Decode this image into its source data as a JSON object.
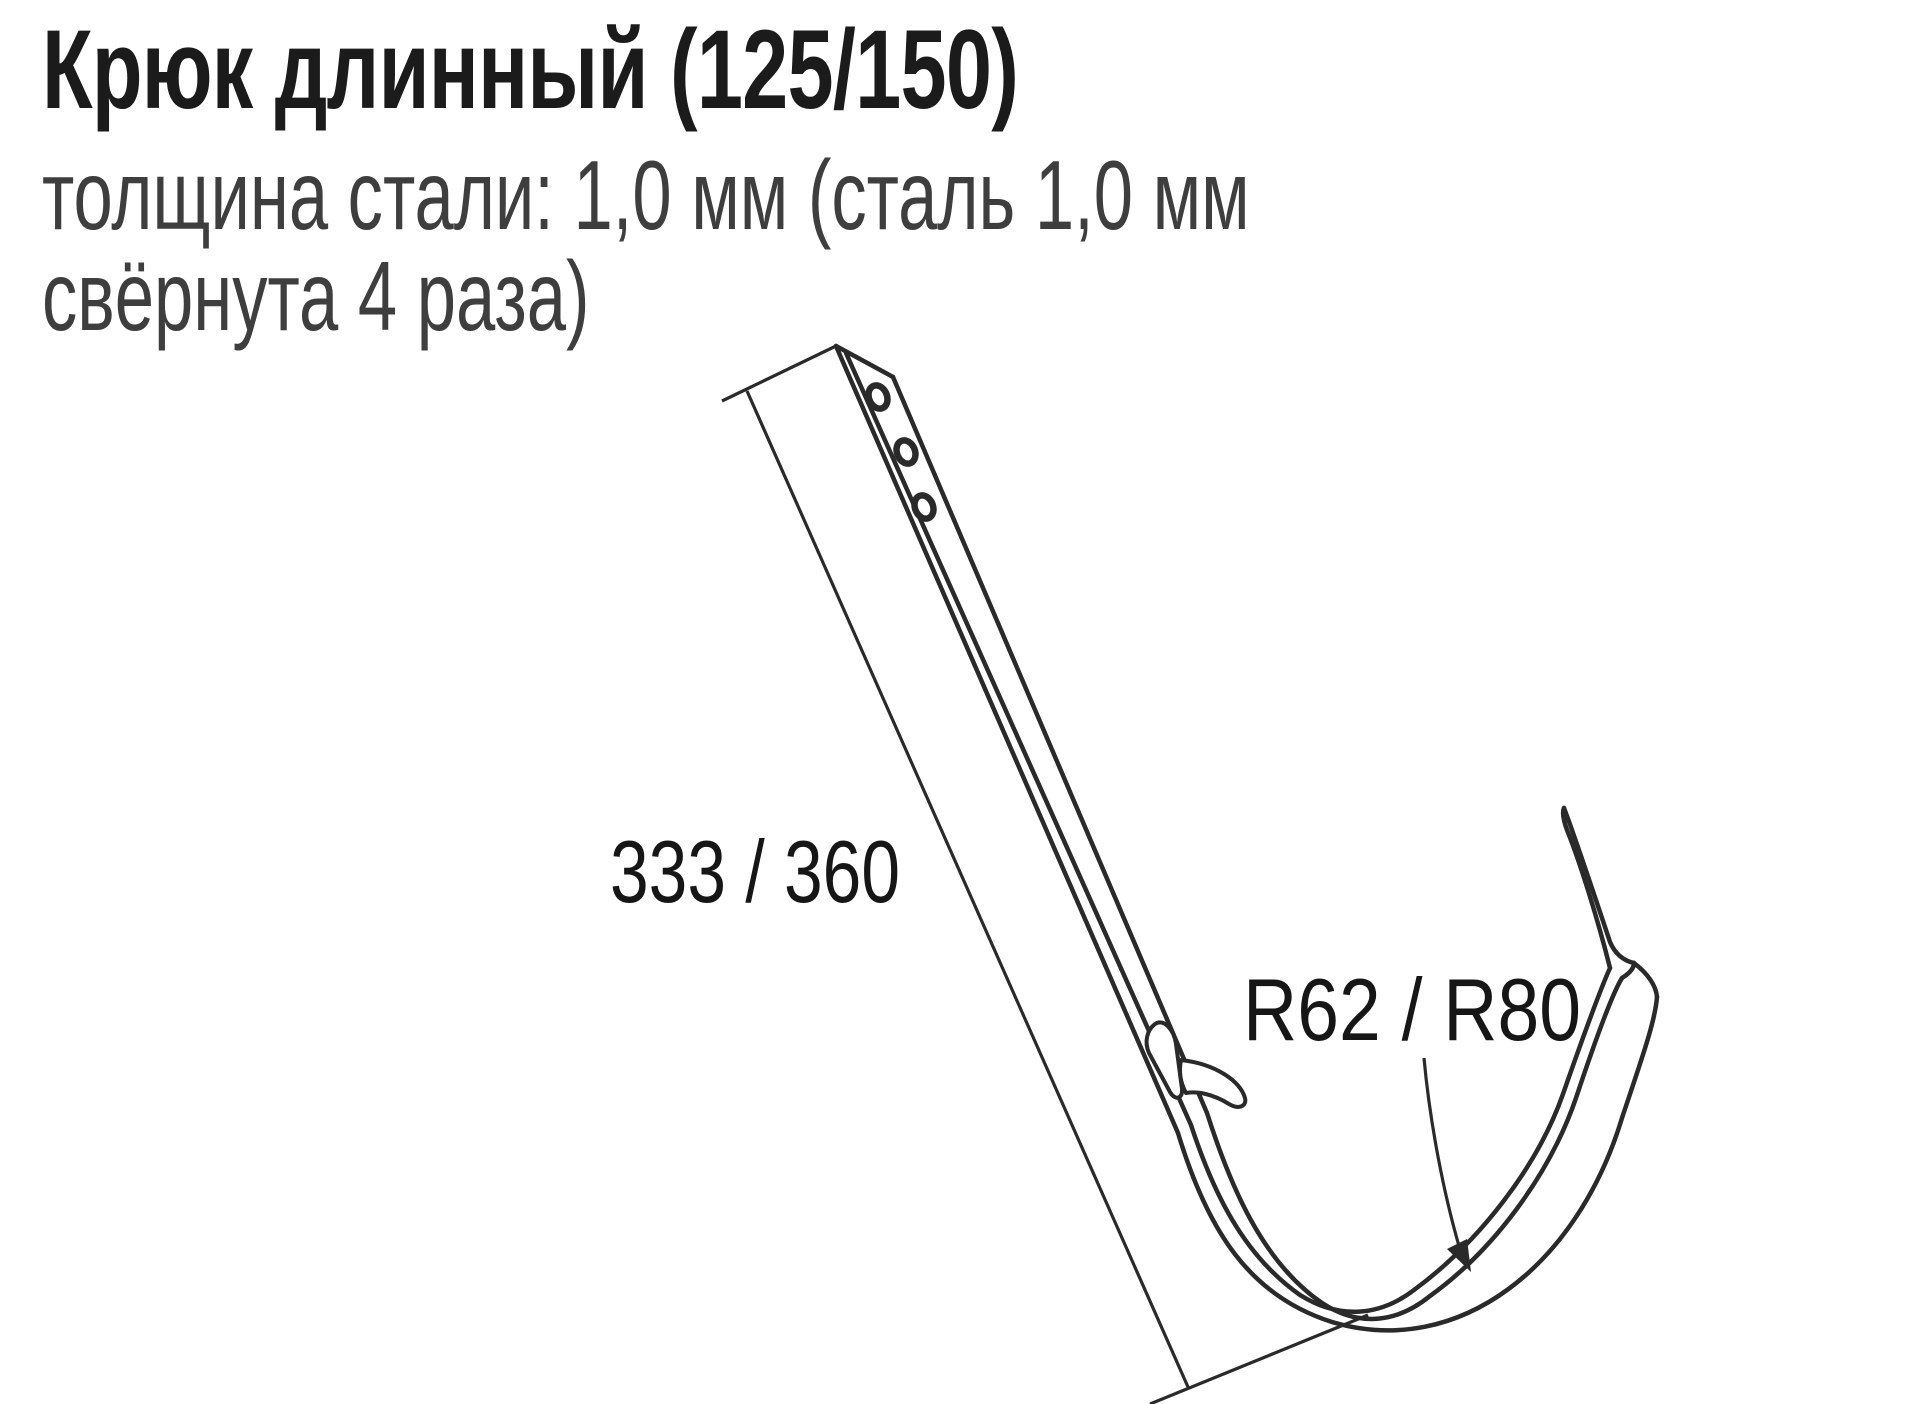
{
  "page": {
    "title": "Крюк длинный (125/150)",
    "subtitle_line1": "толщина стали: 1,0 мм (сталь 1,0 мм",
    "subtitle_line2": "свёрнута 4 раза)",
    "colors": {
      "background": "#ffffff",
      "title_text": "#1b1b1b",
      "subtitle_text": "#3e3e3e",
      "drawing_line": "#2a2a2a",
      "dimension_text": "#161616"
    }
  },
  "diagram": {
    "labels": {
      "length_dimension": "333 / 360",
      "radius_dimension": "R62 / R80"
    }
  }
}
